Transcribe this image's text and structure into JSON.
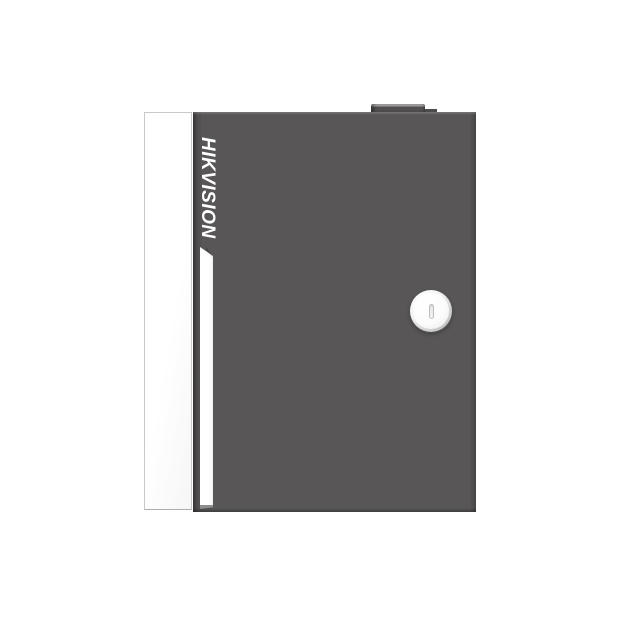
{
  "meta": {
    "type": "product-photo",
    "subject": "Hikvision metal access controller cabinet on white background"
  },
  "product": {
    "brand": "HIKVISION",
    "logo_orientation": "vertical, rotated 90 degrees clockwise, reads top to bottom"
  },
  "parts": {
    "side_panel": "white side panel on left edge",
    "front_door": "dark gray front door",
    "accent_stripe": "white vertical accent stripe with beveled top",
    "key_lock": "round silver key lock with vertical keyhole slot",
    "top_hinge_cap": "small dark hinge cap protruding from top edge"
  },
  "colors": {
    "background": "#ffffff",
    "door_gray": "#585656",
    "door_edge_dark": "#3f3d3d",
    "side_panel_white": "#ffffff",
    "panel_border": "#c9c9c9",
    "stripe_white": "#ffffff",
    "stripe_end_gray": "#8f8d8d",
    "logo_white": "#ffffff",
    "lock_ring_gray": "#8f8f8f",
    "lock_face_white": "#fcfcfc",
    "keyhole_outline": "#bfbfbf",
    "hinge_cap_gray": "#4a4848"
  }
}
